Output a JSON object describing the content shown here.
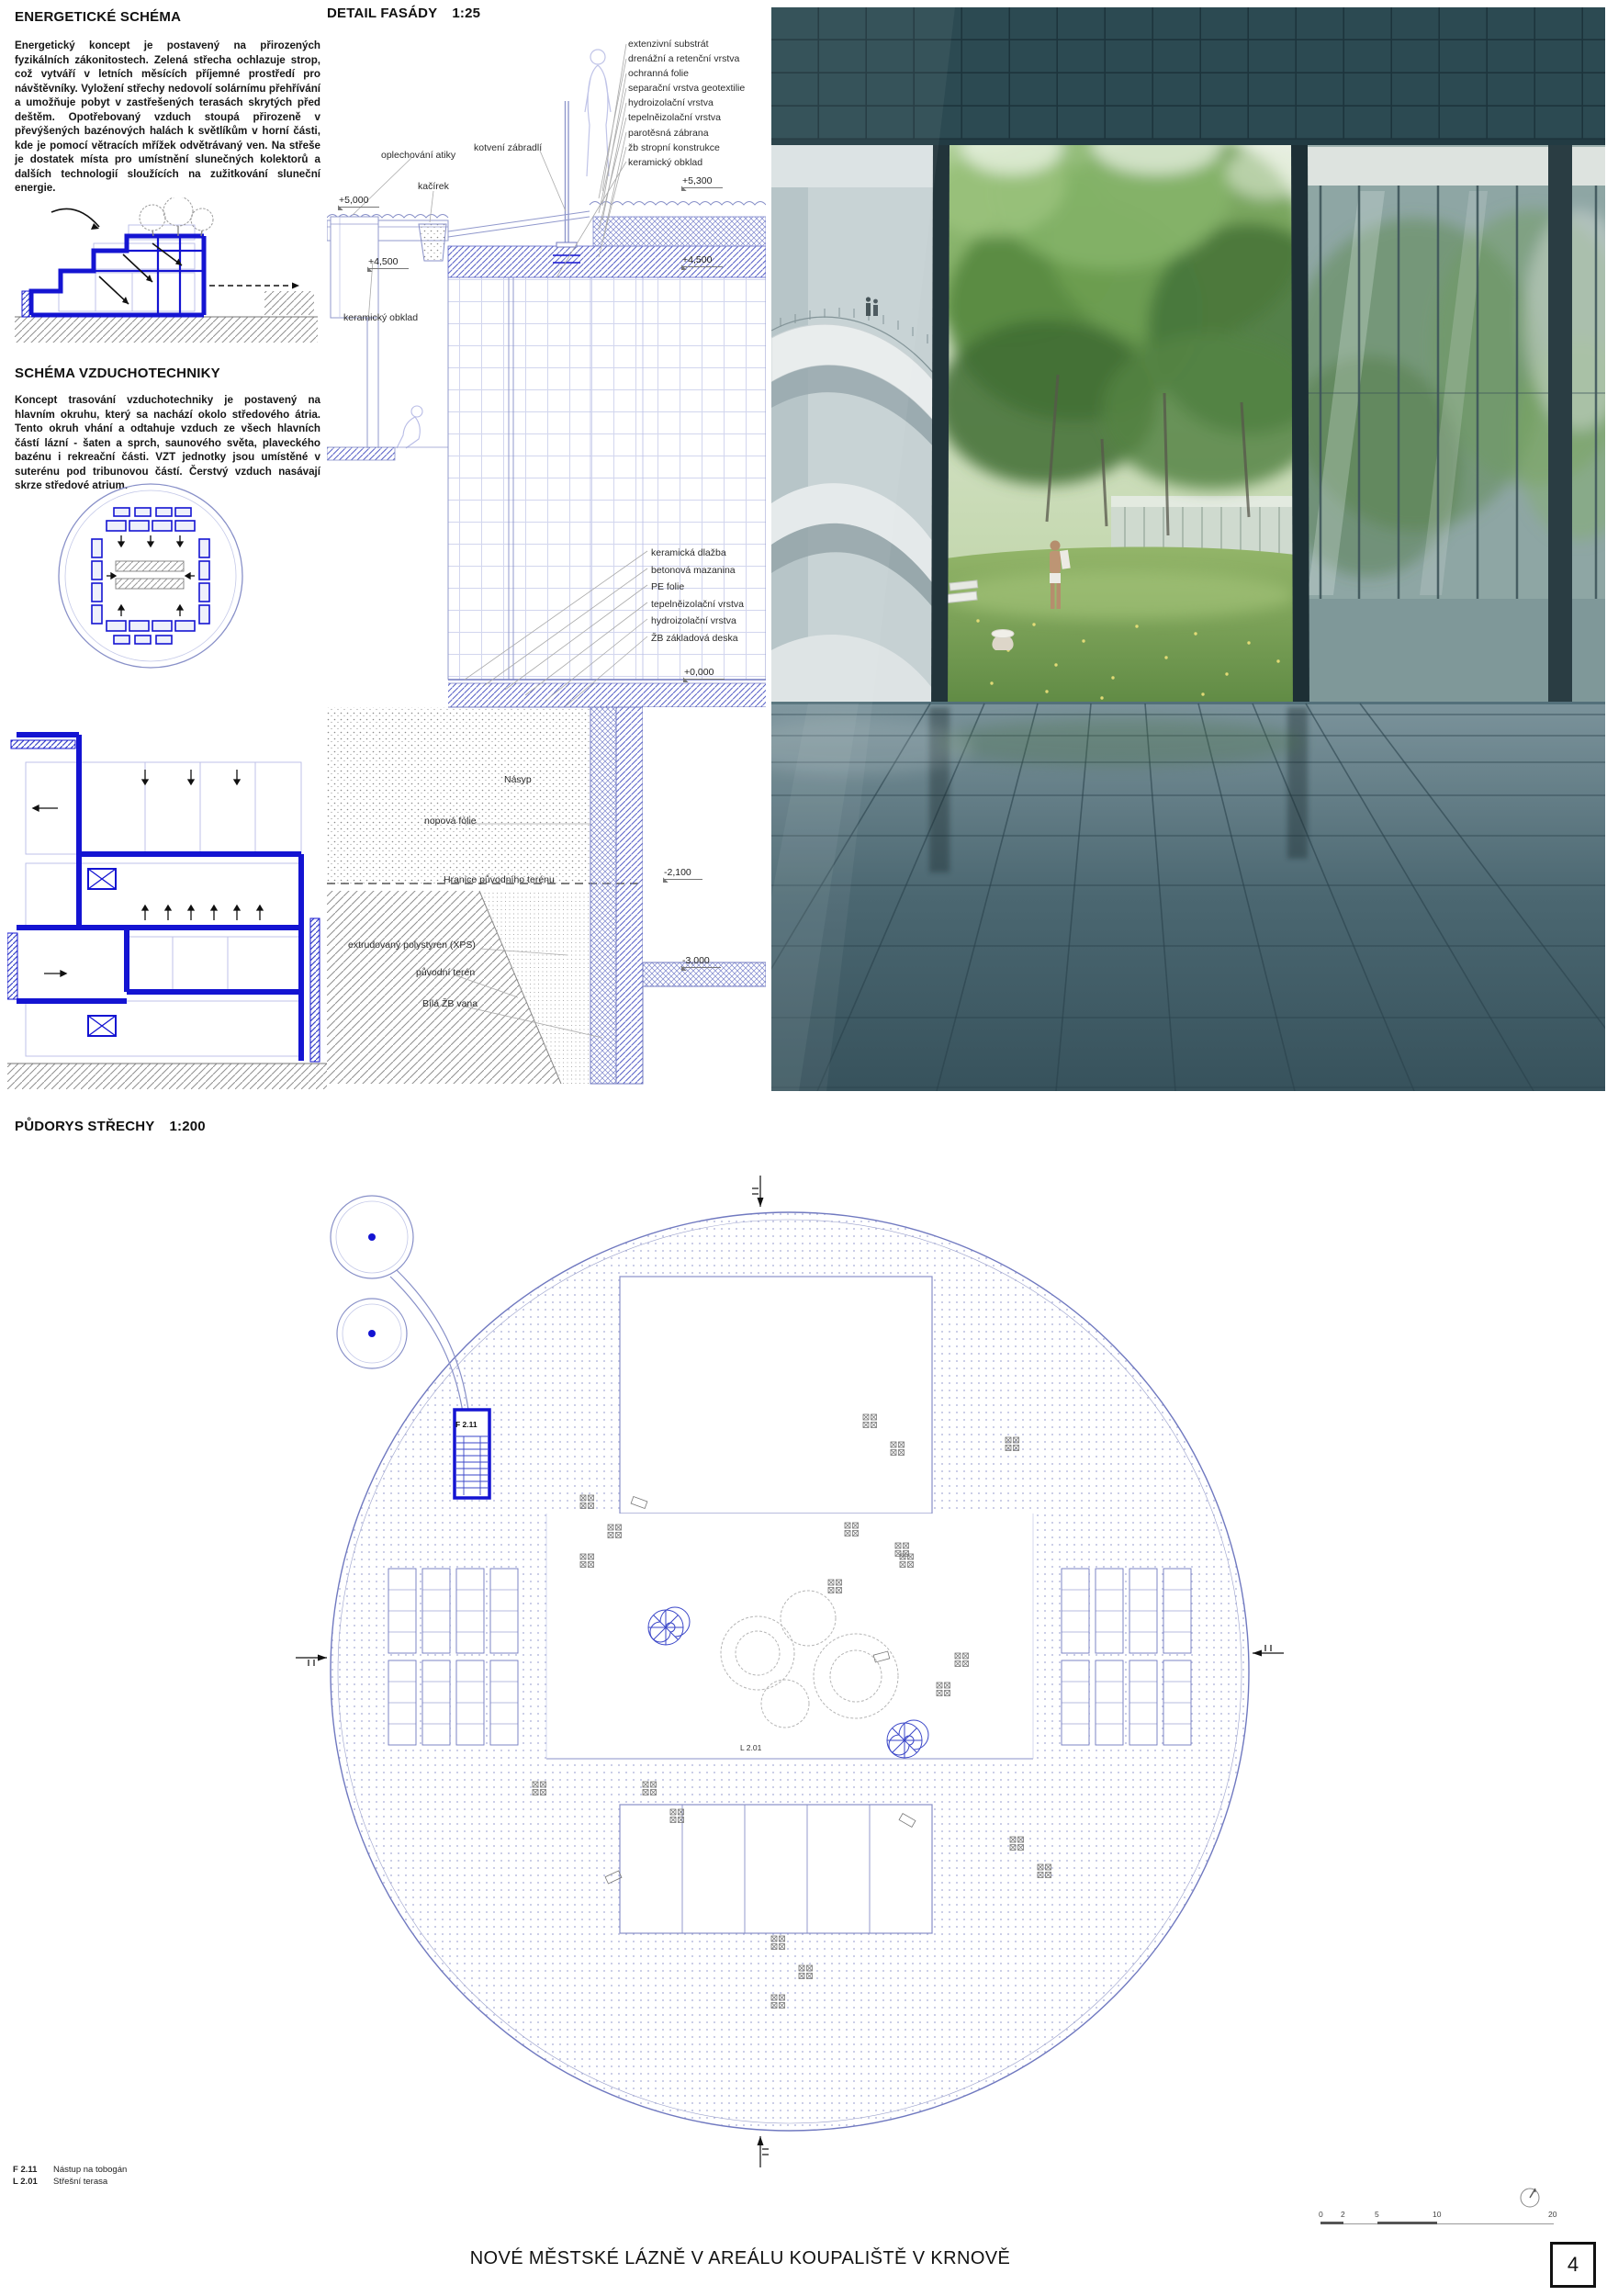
{
  "board": {
    "title": "NOVÉ MĚSTSKÉ LÁZNĚ V AREÁLU KOUPALIŠTĚ V KRNOVĚ",
    "page_number": "4"
  },
  "energy": {
    "heading": "ENERGETICKÉ SCHÉMA",
    "body": "Energetický koncept je postavený na přirozených fyzikálních zákonitostech. Zelená střecha ochlazuje strop, což vytváří v letních měsících příjemné prostředí pro návštěvníky. Vyložení střechy nedovolí solárnímu přehřívání a umožňuje pobyt v zastřešených terasách skrytých před deštěm. Opotřebovaný vzduch stoupá přirozeně v převýšených bazénových halách k světlíkům v horní části, kde je pomocí větracích mřížek odvětrávaný ven. Na střeše je dostatek místa pro umístnění slunečných kolektorů a dalších technologií sloužících na zužitkování sluneční energie."
  },
  "hvac": {
    "heading": "SCHÉMA VZDUCHOTECHNIKY",
    "body": "Koncept trasování vzduchotechniky je postavený na hlavním okruhu, který sa nachází okolo středového átria. Tento okruh vhání a odtahuje vzduch ze všech hlavních částí lázní - šaten a sprch, saunového světa, plaveckého bazénu i rekreační části. VZT jednotky jsou umístěné v suterénu pod tribunovou částí. Čerstvý vzduch nasávají skrze středové atrium."
  },
  "facade": {
    "heading": "DETAIL FASÁDY",
    "scale": "1:25",
    "roof_layers": [
      "extenzivní substrát",
      "drenážní a retenční vrstva",
      "ochranná folie",
      "separační vrstva geotextilie",
      "hydroizolační vrstva",
      "tepelněizolační vrstva",
      "parotěsná zábrana",
      "žb stropní konstrukce",
      "keramický obklad"
    ],
    "floor_layers": [
      "keramická dlažba",
      "betonová mazanina",
      "PE folie",
      "tepelněizolační vrstva",
      "hydroizolační vrstva",
      "ŽB základová deska"
    ],
    "labels": {
      "oplechovani": "oplechování atiky",
      "kotveni": "kotvení zábradlí",
      "kacirek": "kačírek",
      "keramicky_obklad": "keramický obklad",
      "nasyp": "Násyp",
      "nopova": "nopová fólie",
      "hranice": "Hranice původního terénu",
      "xps": "extrudovaný polystyren (XPS)",
      "puvodni_teren": "původní terén",
      "bila_vana": "Bílá ŽB vana"
    },
    "elevations": {
      "plus5000": "+5,000",
      "plus5300": "+5,300",
      "plus4500_left": "+4,500",
      "plus4500_right": "+4,500",
      "zero": "+0,000",
      "minus2100": "-2,100",
      "minus3000": "-3,000"
    }
  },
  "roof_plan": {
    "heading": "PŮDORYS STŘECHY",
    "scale": "1:200",
    "stair_label": "F 2.11",
    "terrace_label": "L 2.01"
  },
  "legend": {
    "items": [
      {
        "code": "F 2.11",
        "label": "Nástup na tobogán"
      },
      {
        "code": "L 2.01",
        "label": "Střešní terasa"
      }
    ]
  },
  "scale_bar": {
    "ticks": [
      "0",
      "2",
      "5",
      "10",
      "20"
    ]
  },
  "colors": {
    "drawing_blue": "#1414d2",
    "line_lavender": "#8890c8",
    "text": "#111111"
  }
}
